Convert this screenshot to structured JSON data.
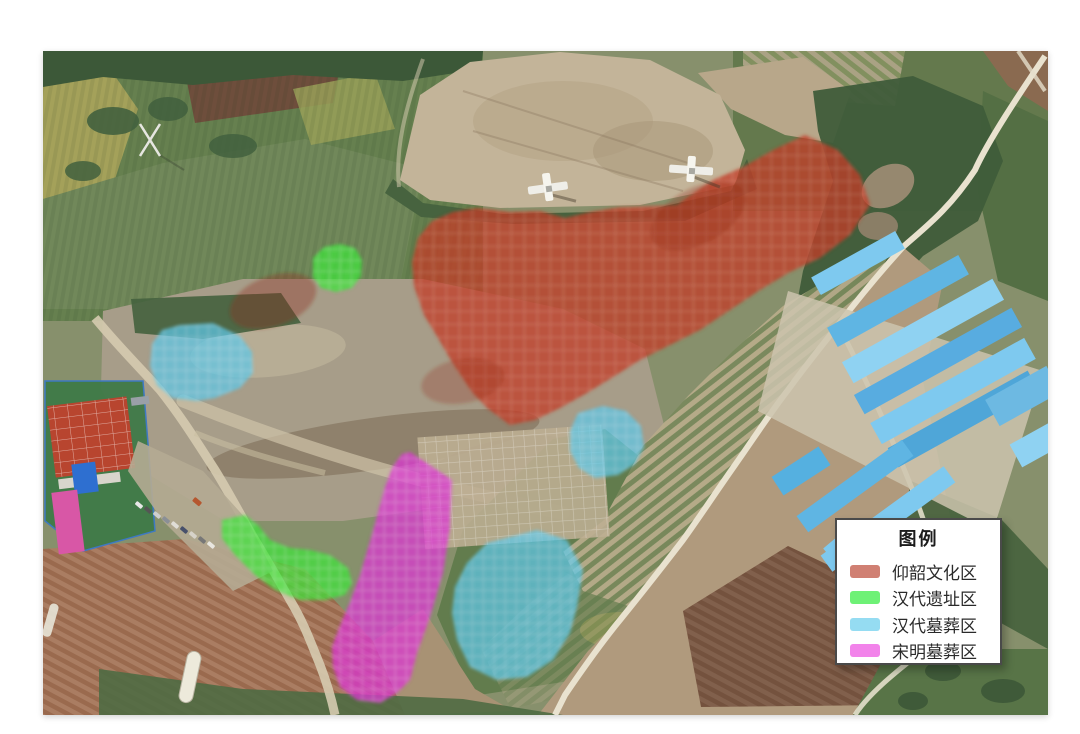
{
  "legend": {
    "title": "图例",
    "items": [
      {
        "id": "yangshao-culture-zone",
        "label": "仰韶文化区",
        "swatch_color": "#d08073"
      },
      {
        "id": "han-dynasty-site-zone",
        "label": "汉代遗址区",
        "swatch_color": "#6ef176"
      },
      {
        "id": "han-dynasty-tomb-zone",
        "label": "汉代墓葬区",
        "swatch_color": "#95dcf2"
      },
      {
        "id": "song-ming-tomb-zone",
        "label": "宋明墓葬区",
        "swatch_color": "#f283ea"
      }
    ]
  },
  "map_overlay_zones": {
    "yangshao_culture": {
      "label": "仰韶文化区",
      "color": "#c23e27"
    },
    "han_site": {
      "label": "汉代遗址区",
      "color": "#3de53a"
    },
    "han_tombs": {
      "label": "汉代墓葬区",
      "color": "#5fc8e8"
    },
    "song_ming_tombs": {
      "label": "宋明墓葬区",
      "color": "#dc37d3"
    }
  }
}
